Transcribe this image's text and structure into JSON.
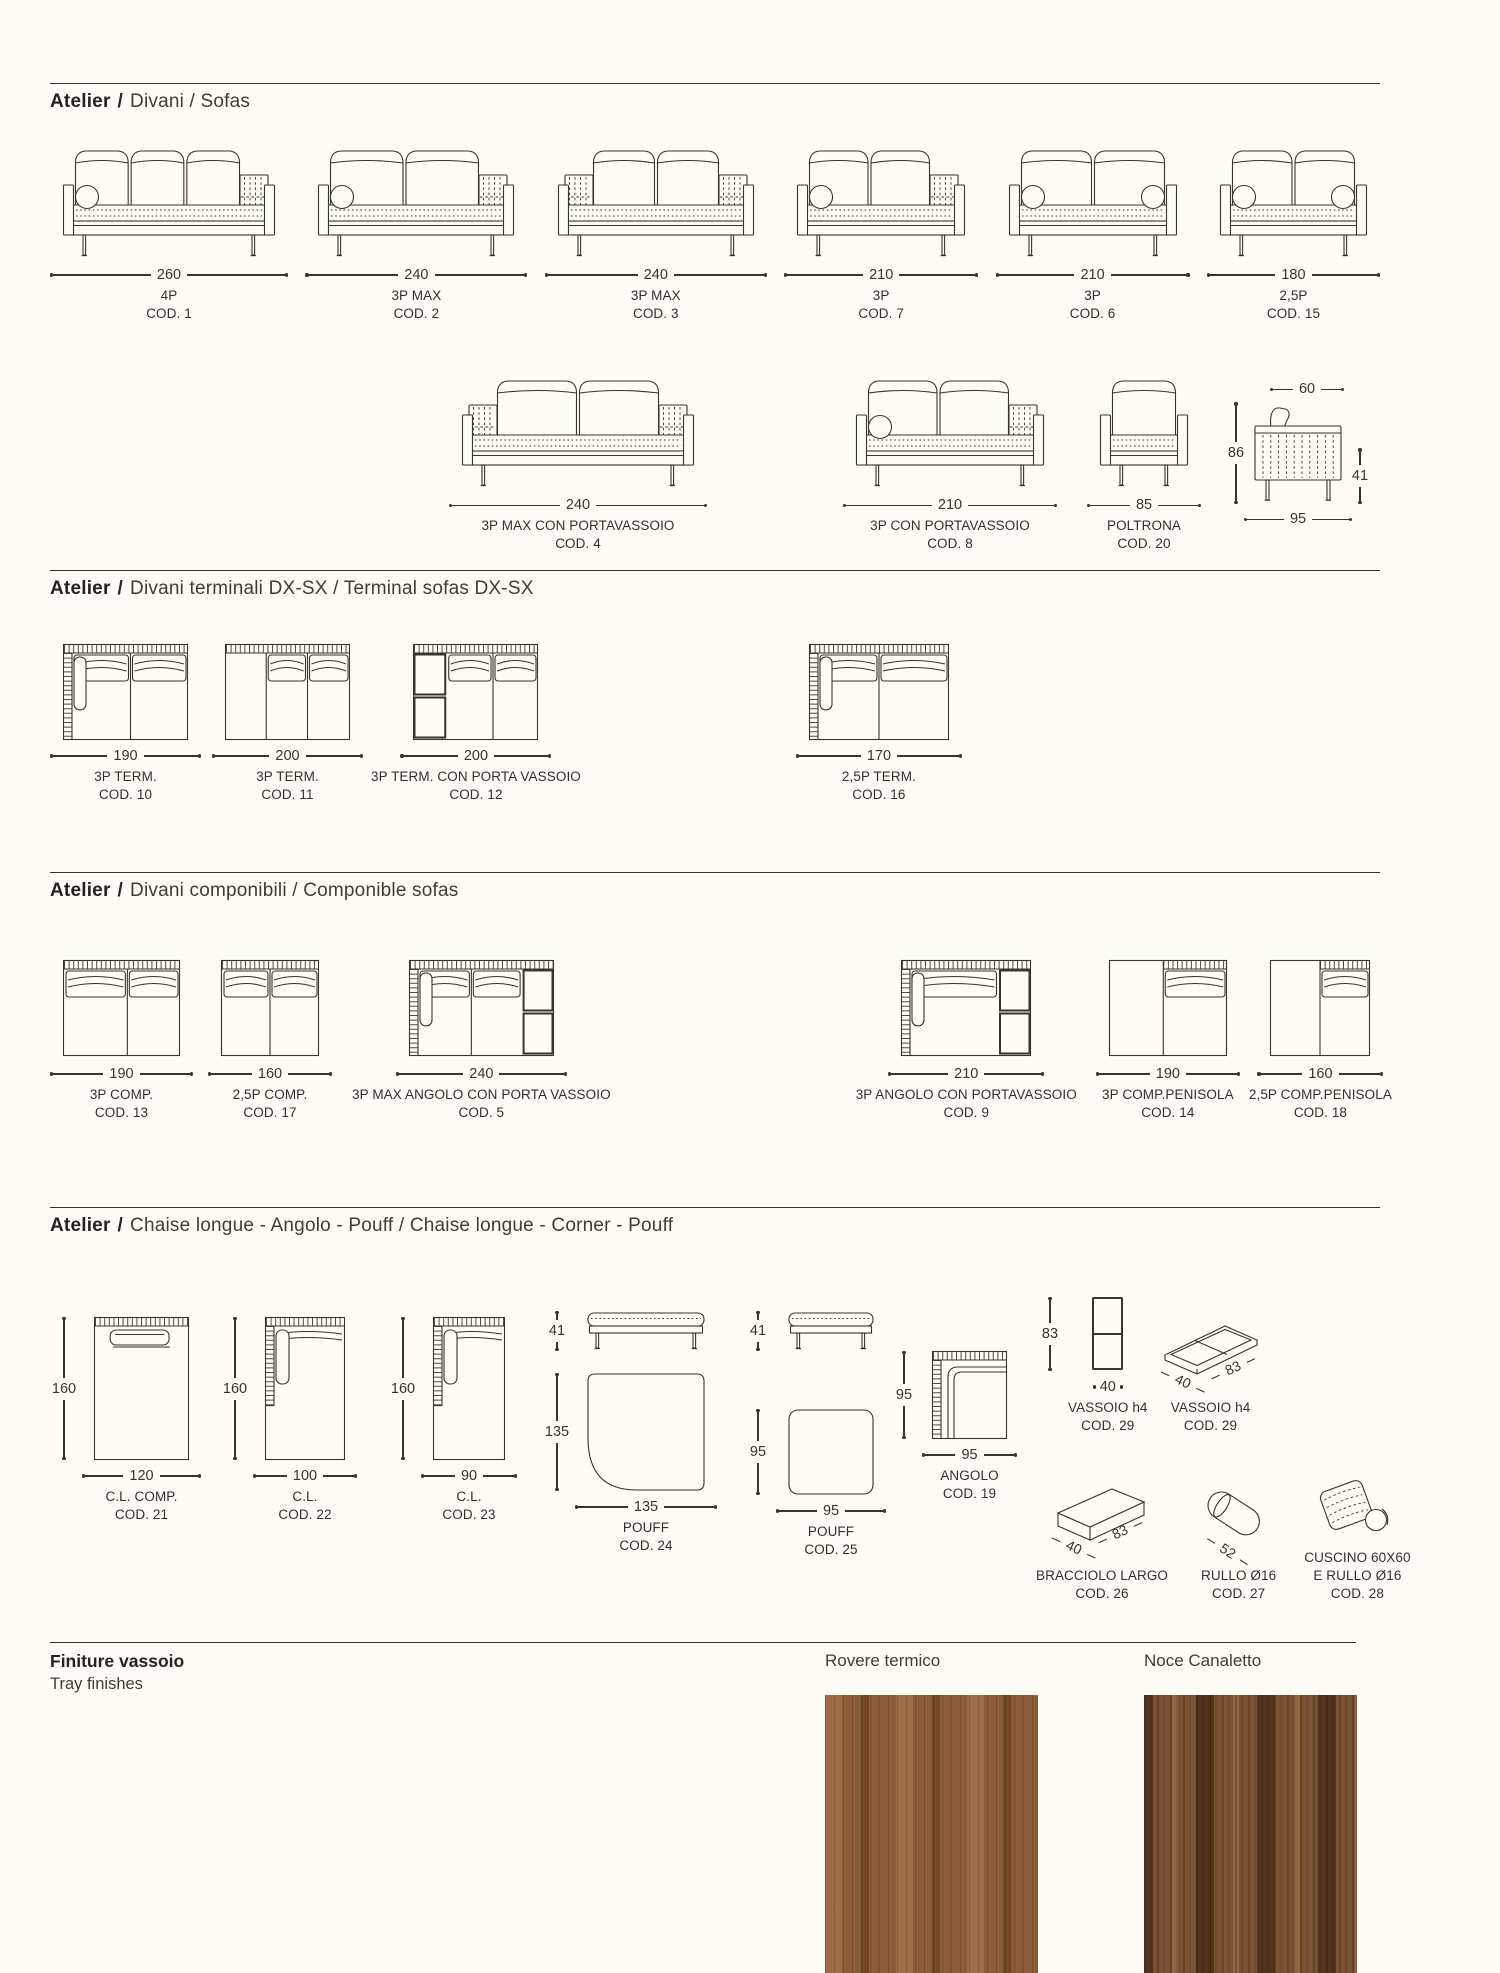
{
  "page": {
    "bg": "#fdfcf6",
    "ink": "#38342f",
    "width": 1500,
    "height": 1973
  },
  "sections": [
    {
      "title_brand": "Atelier",
      "title_sep": "/",
      "title_text": "Divani / Sofas",
      "rows": [
        {
          "cls": "r1",
          "items": [
            {
              "shape": "sofa_front",
              "dim": "260",
              "name": "4P",
              "code": "COD. 1",
              "w": 212,
              "cushions": 3,
              "left": "bolster",
              "right": "quilt"
            },
            {
              "shape": "sofa_front",
              "dim": "240",
              "name": "3P MAX",
              "code": "COD. 2",
              "w": 196,
              "cushions": 2,
              "left": "bolster",
              "right": "quilt"
            },
            {
              "shape": "sofa_front",
              "dim": "240",
              "name": "3P MAX",
              "code": "COD. 3",
              "w": 196,
              "cushions": 2,
              "left": "quilt",
              "right": "quilt"
            },
            {
              "shape": "sofa_front",
              "dim": "210",
              "name": "3P",
              "code": "COD. 7",
              "w": 168,
              "cushions": 2,
              "left": "bolster",
              "right": "quilt"
            },
            {
              "shape": "sofa_front",
              "dim": "210",
              "name": "3P",
              "code": "COD. 6",
              "w": 168,
              "cushions": 2,
              "left": "bolster",
              "right": "bolster"
            },
            {
              "shape": "sofa_front",
              "dim": "180",
              "name": "2,5P",
              "code": "COD. 15",
              "w": 147,
              "cushions": 2,
              "left": "bolster",
              "right": "bolster"
            }
          ]
        },
        {
          "cls": "r2",
          "items": [
            {
              "shape": "sofa_front",
              "dim": "240",
              "name": "3P MAX CON PORTAVASSOIO",
              "code": "COD. 4",
              "w": 232,
              "cushions": 2,
              "left": "quilt",
              "right": "quilt",
              "ml": 399
            },
            {
              "shape": "sofa_front",
              "dim": "210",
              "name": "3P CON PORTAVASSOIO",
              "code": "COD. 8",
              "w": 188,
              "cushions": 2,
              "left": "bolster",
              "right": "quilt",
              "ml": 136
            },
            {
              "shape": "armchair_front",
              "dim": "85",
              "name": "POLTRONA",
              "code": "COD. 20",
              "w": 88,
              "cushions": 1,
              "left": "plain",
              "right": "plain",
              "ml": 30
            },
            {
              "shape": "sofa_side",
              "w": 88,
              "ml": 21,
              "dim_top": "60",
              "dim_left": "86",
              "dim_bottom": "95",
              "dim_right": "41"
            }
          ]
        }
      ]
    },
    {
      "title_brand": "Atelier",
      "title_sep": "/",
      "title_text": "Divani terminali DX-SX / Terminal sofas DX-SX",
      "rows": [
        {
          "cls": "r3",
          "items": [
            {
              "shape": "sofa_top",
              "dim": "190",
              "name": "3P TERM.",
              "code": "COD. 10",
              "w": 125,
              "hatch_left": true,
              "bolster": true,
              "divs": [
                0.54
              ],
              "cush": [
                0,
                1
              ]
            },
            {
              "shape": "sofa_top",
              "dim": "200",
              "name": "3P TERM.",
              "code": "COD. 11",
              "w": 125,
              "divs": [
                0.33,
                0.66
              ],
              "cush": [
                0.33,
                1
              ],
              "ml": 11
            },
            {
              "shape": "sofa_top",
              "dim": "200",
              "name": "3P TERM. CON PORTA VASSOIO",
              "code": "COD. 12",
              "w": 125,
              "tray": "left",
              "trayf": 0.27,
              "divs": [
                0.64
              ],
              "cush": [
                0.27,
                1
              ],
              "ml": 8
            },
            {
              "shape": "sofa_top",
              "dim": "170",
              "name": "2,5P TERM.",
              "code": "COD. 16",
              "w": 140,
              "hatch_left": true,
              "bolster": true,
              "divs": [
                0.5
              ],
              "cush": [
                0,
                1
              ],
              "ml": 215
            }
          ]
        }
      ]
    },
    {
      "title_brand": "Atelier",
      "title_sep": "/",
      "title_text": "Divani componibili / Componible sofas",
      "rows": [
        {
          "cls": "r4",
          "items": [
            {
              "shape": "sofa_top",
              "dim": "190",
              "name": "3P COMP.",
              "code": "COD. 13",
              "w": 117,
              "divs": [
                0.55
              ],
              "cush": [
                0,
                1
              ]
            },
            {
              "shape": "sofa_top",
              "dim": "160",
              "name": "2,5P COMP.",
              "code": "COD. 17",
              "w": 98,
              "divs": [
                0.5
              ],
              "cush": [
                0,
                1
              ],
              "ml": 15
            },
            {
              "shape": "sofa_top",
              "dim": "240",
              "name": "3P MAX ANGOLO CON PORTA VASSOIO",
              "code": "COD. 5",
              "w": 145,
              "hatch_left": true,
              "bolster": true,
              "tray": "right",
              "trayf": 0.78,
              "divs": [
                0.43
              ],
              "cush": [
                0,
                0.78
              ],
              "ml": 20
            },
            {
              "shape": "sofa_top",
              "dim": "210",
              "name": "3P ANGOLO CON PORTAVASSOIO",
              "code": "COD. 9",
              "w": 130,
              "hatch_left": true,
              "bolster": true,
              "tray": "right",
              "trayf": 0.75,
              "cush": [
                0,
                0.75
              ],
              "ml": 245
            },
            {
              "shape": "sofa_top",
              "dim": "190",
              "name": "3P COMP.PENISOLA",
              "code": "COD. 14",
              "w": 118,
              "pen": 0.46,
              "cush": [
                0.46,
                1
              ],
              "ml": 19
            },
            {
              "shape": "sofa_top",
              "dim": "160",
              "name": "2,5P COMP.PENISOLA",
              "code": "COD. 18",
              "w": 100,
              "pen": 0.5,
              "cush": [
                0.5,
                1
              ],
              "ml": 9
            }
          ]
        }
      ]
    },
    {
      "title_brand": "Atelier",
      "title_sep": "/",
      "title_text": "Chaise longue - Angolo - Pouff / Chaise longue - Corner - Pouff",
      "rows": [
        {
          "cls": "r5",
          "items": [
            {
              "shape": "cl_top",
              "vdim": "160",
              "dim": "120",
              "name": "C.L. COMP.",
              "code": "COD. 21",
              "w": 95,
              "h": 143,
              "bolster": "h",
              "mt": 34
            },
            {
              "shape": "cl_top",
              "vdim": "160",
              "dim": "100",
              "name": "C.L.",
              "code": "COD. 22",
              "w": 80,
              "h": 143,
              "bolster": "v",
              "hatch_left": true,
              "ml": 20,
              "mt": 34
            },
            {
              "shape": "cl_top",
              "vdim": "160",
              "dim": "90",
              "name": "C.L.",
              "code": "COD. 23",
              "w": 72,
              "h": 143,
              "bolster": "v",
              "hatch_left": true,
              "ml": 32,
              "mt": 34
            },
            {
              "shape": "pouf",
              "sdim": "41",
              "vdim": "135",
              "dim": "135",
              "name": "POUFF",
              "code": "COD. 24",
              "w": 118,
              "th": 118,
              "round": "bl",
              "gap": 22,
              "ml": 26,
              "mt": 28
            },
            {
              "shape": "pouf",
              "sdim": "41",
              "vdim": "95",
              "dim": "95",
              "name": "POUFF",
              "code": "COD. 25",
              "w": 86,
              "th": 86,
              "gap": 58,
              "ml": 27,
              "mt": 28
            },
            {
              "shape": "angolo",
              "vdim": "95",
              "dim": "95",
              "name": "ANGOLO",
              "code": "COD. 19",
              "w": 75,
              "h": 88,
              "ml": 4,
              "mt": 68
            },
            {
              "shape": "group",
              "ml": 19,
              "mt": 14,
              "rows": [
                [
                  {
                    "shape": "tray_flat",
                    "vdim": "83",
                    "dim": "40",
                    "name": "VASSOIO h4",
                    "code": "COD. 29"
                  },
                  {
                    "shape": "tray_iso",
                    "name": "VASSOIO h4",
                    "code": "COD. 29",
                    "d1": "40",
                    "d2": "83",
                    "ml": 13
                  }
                ],
                [
                  {
                    "shape": "block_iso",
                    "name": "BRACCIOLO LARGO",
                    "code": "COD. 26",
                    "d1": "40",
                    "d2": "83"
                  },
                  {
                    "shape": "cylinder_iso",
                    "name": "RULLO Ø16",
                    "code": "COD. 27",
                    "d1": "52",
                    "ml": 33
                  },
                  {
                    "shape": "cushion_iso",
                    "name": "CUSCINO 60X60",
                    "name2": "E RULLO Ø16",
                    "code": "COD. 28",
                    "ml": 28
                  }
                ]
              ]
            }
          ]
        }
      ]
    }
  ],
  "finishes": {
    "title": "Finiture vassoio",
    "subtitle": "Tray finishes",
    "items": [
      {
        "label": "Rovere termico",
        "base": "#8a5b38",
        "dark": "#714526",
        "light": "#9b6c45"
      },
      {
        "label": "Noce Canaletto",
        "base": "#7a5233",
        "dark": "#54331d",
        "light": "#8f6640"
      }
    ]
  }
}
